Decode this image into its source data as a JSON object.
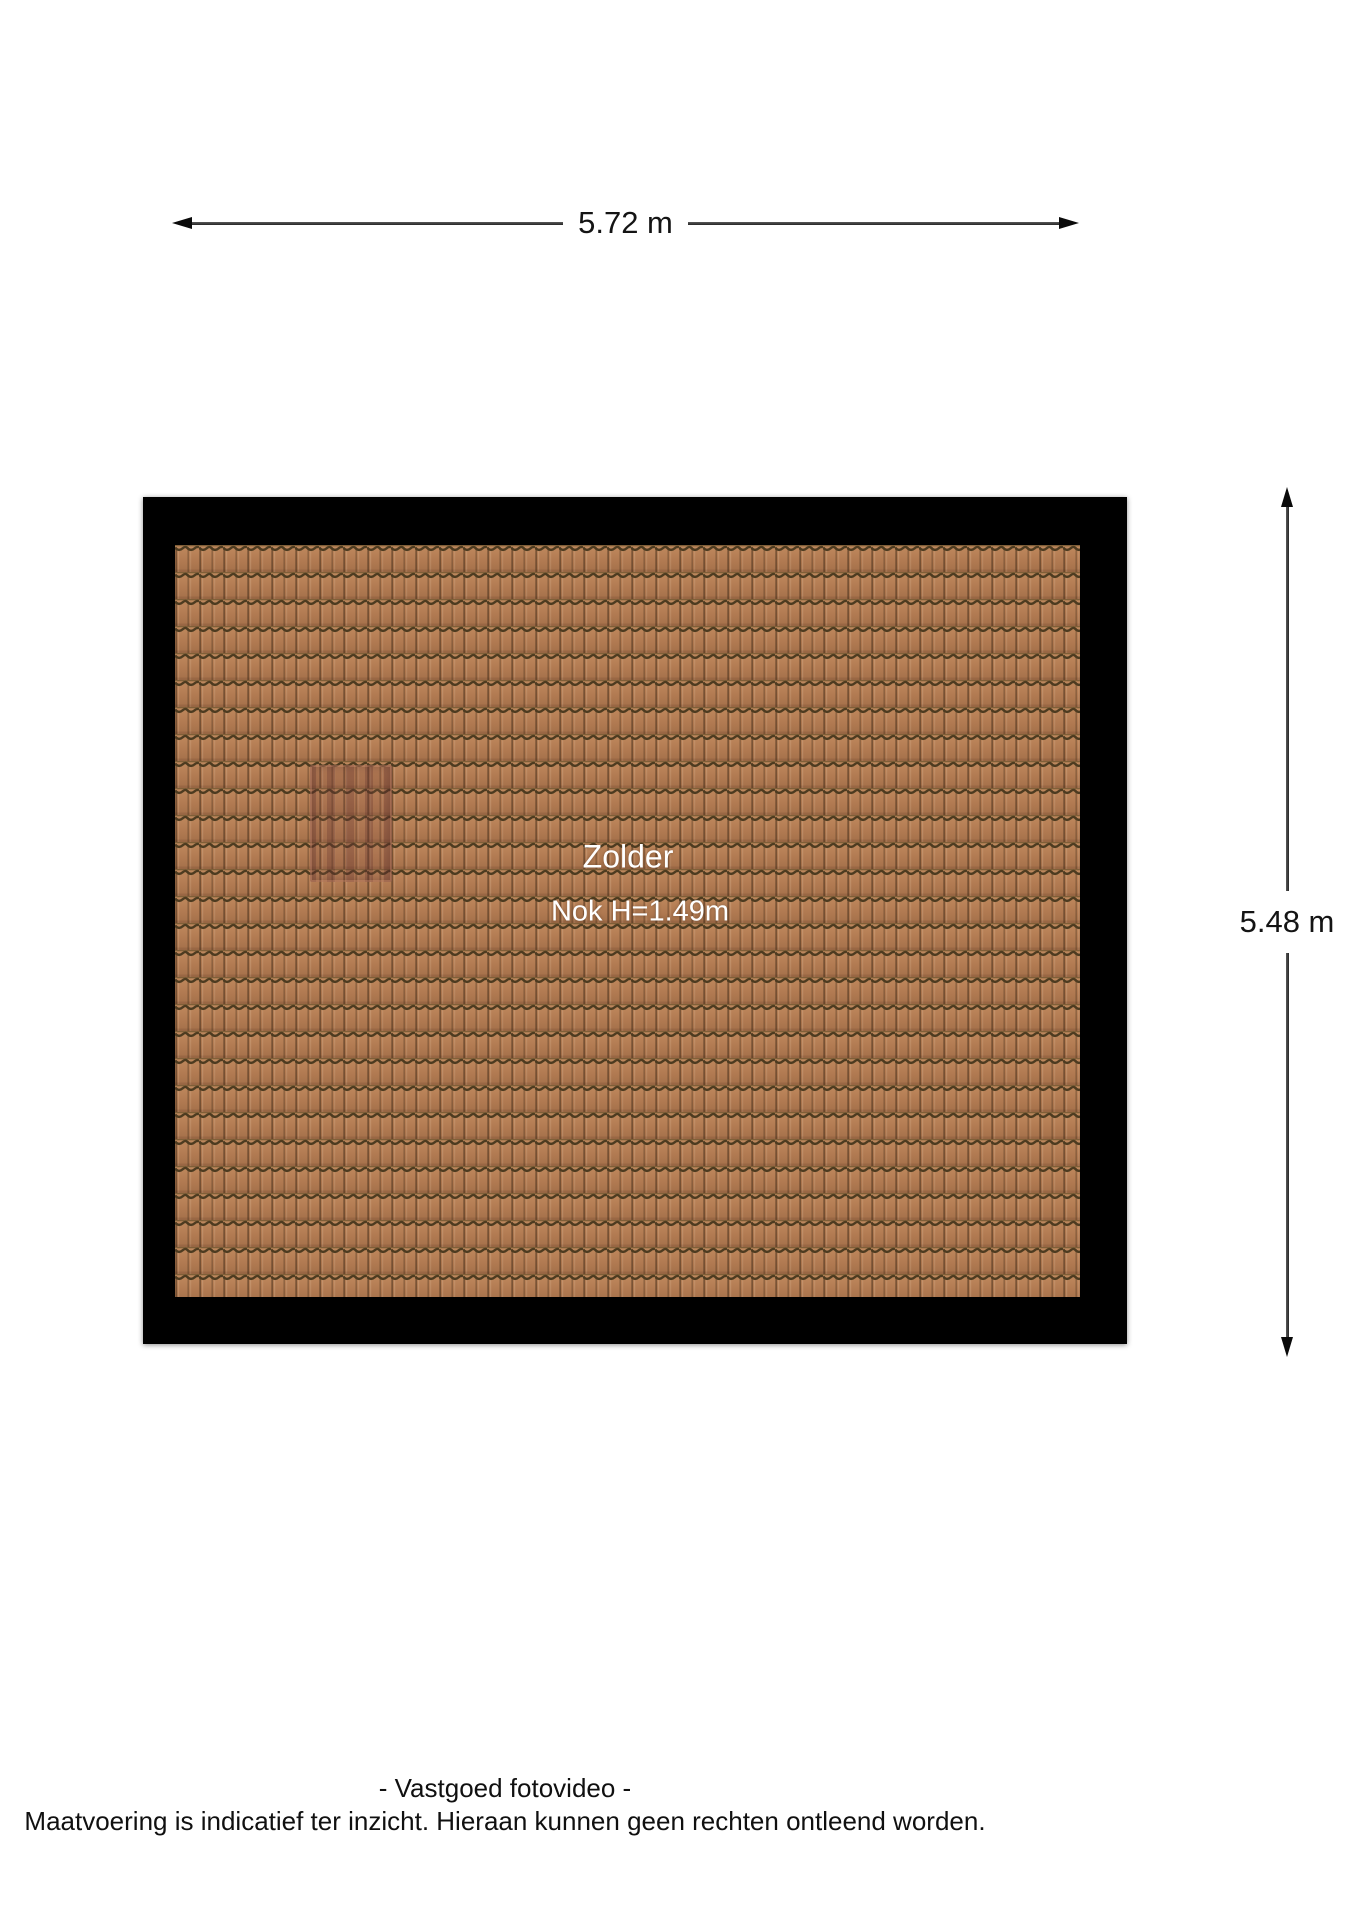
{
  "dimensions": {
    "top": {
      "label": "5.72 m"
    },
    "right": {
      "label": "5.48 m"
    }
  },
  "room": {
    "name": "Zolder",
    "ridge_height": "Nok H=1.49m"
  },
  "footer": {
    "line1": "- Vastgoed fotovideo -",
    "line2": "Maatvoering is indicatief ter inzicht. Hieraan kunnen geen rechten ontleend worden."
  },
  "colors": {
    "frame": "#000000",
    "tile_body": "#b27b52",
    "tile_body_light": "#c08a5e",
    "tile_body_dark": "#a4704a",
    "tile_groove": "#4d3b20",
    "dimension_line": "#3a3a3a",
    "dimension_text": "#141414",
    "room_label_text": "#ffffff",
    "background": "#ffffff"
  }
}
